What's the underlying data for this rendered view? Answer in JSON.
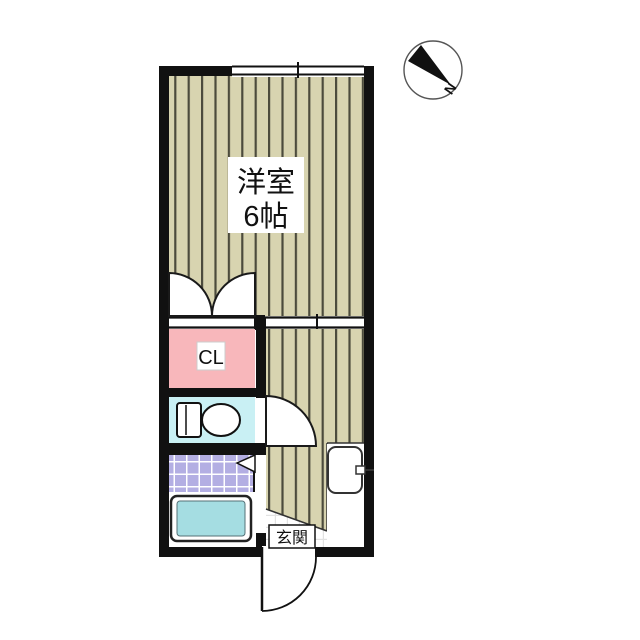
{
  "floor_plan": {
    "rooms": {
      "western_room": {
        "name_line1": "洋室",
        "name_line2": "6帖"
      },
      "closet": {
        "label": "CL"
      },
      "entrance": {
        "label": "玄関"
      }
    },
    "compass": {
      "label": "N"
    },
    "colors": {
      "wall": "#111111",
      "flooring_base": "#d8d4b0",
      "flooring_stripe": "#4c4b3c",
      "closet_fill": "#f8b7bb",
      "toilet_fill": "#c9f0f4",
      "bathroom_tile": "#b3aee3",
      "bathtub_fill": "#a5dde2",
      "genkan_tile_line": "#e2e2e2"
    }
  }
}
